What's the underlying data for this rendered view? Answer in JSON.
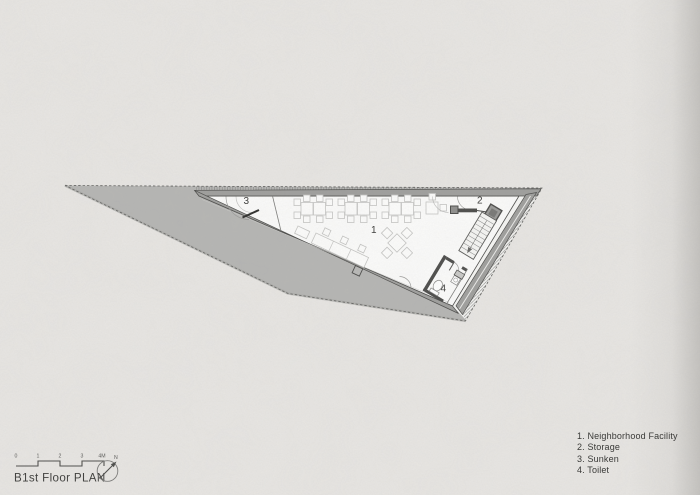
{
  "title_block": {
    "plan_title": "B1st Floor PLAN",
    "north_label": "N",
    "scale_ticks": [
      "0",
      "1",
      "2",
      "3",
      "4M"
    ]
  },
  "legend": {
    "items": [
      "1. Neighborhood Facility",
      "2. Storage",
      "3. Sunken",
      "4. Toilet"
    ]
  },
  "plan": {
    "room_labels": {
      "neighborhood_facility": "1",
      "storage": "2",
      "sunken": "3",
      "toilet": "4"
    }
  },
  "colors": {
    "paper": "#e8e6e3",
    "site_fill": "#b5b5b3",
    "wall_fill": "#9e9e9c",
    "wall_dark": "#4c4c4a",
    "floor": "#fcfcfb",
    "furniture_line": "#c5c5c3",
    "text_dark": "#3a3a38"
  }
}
